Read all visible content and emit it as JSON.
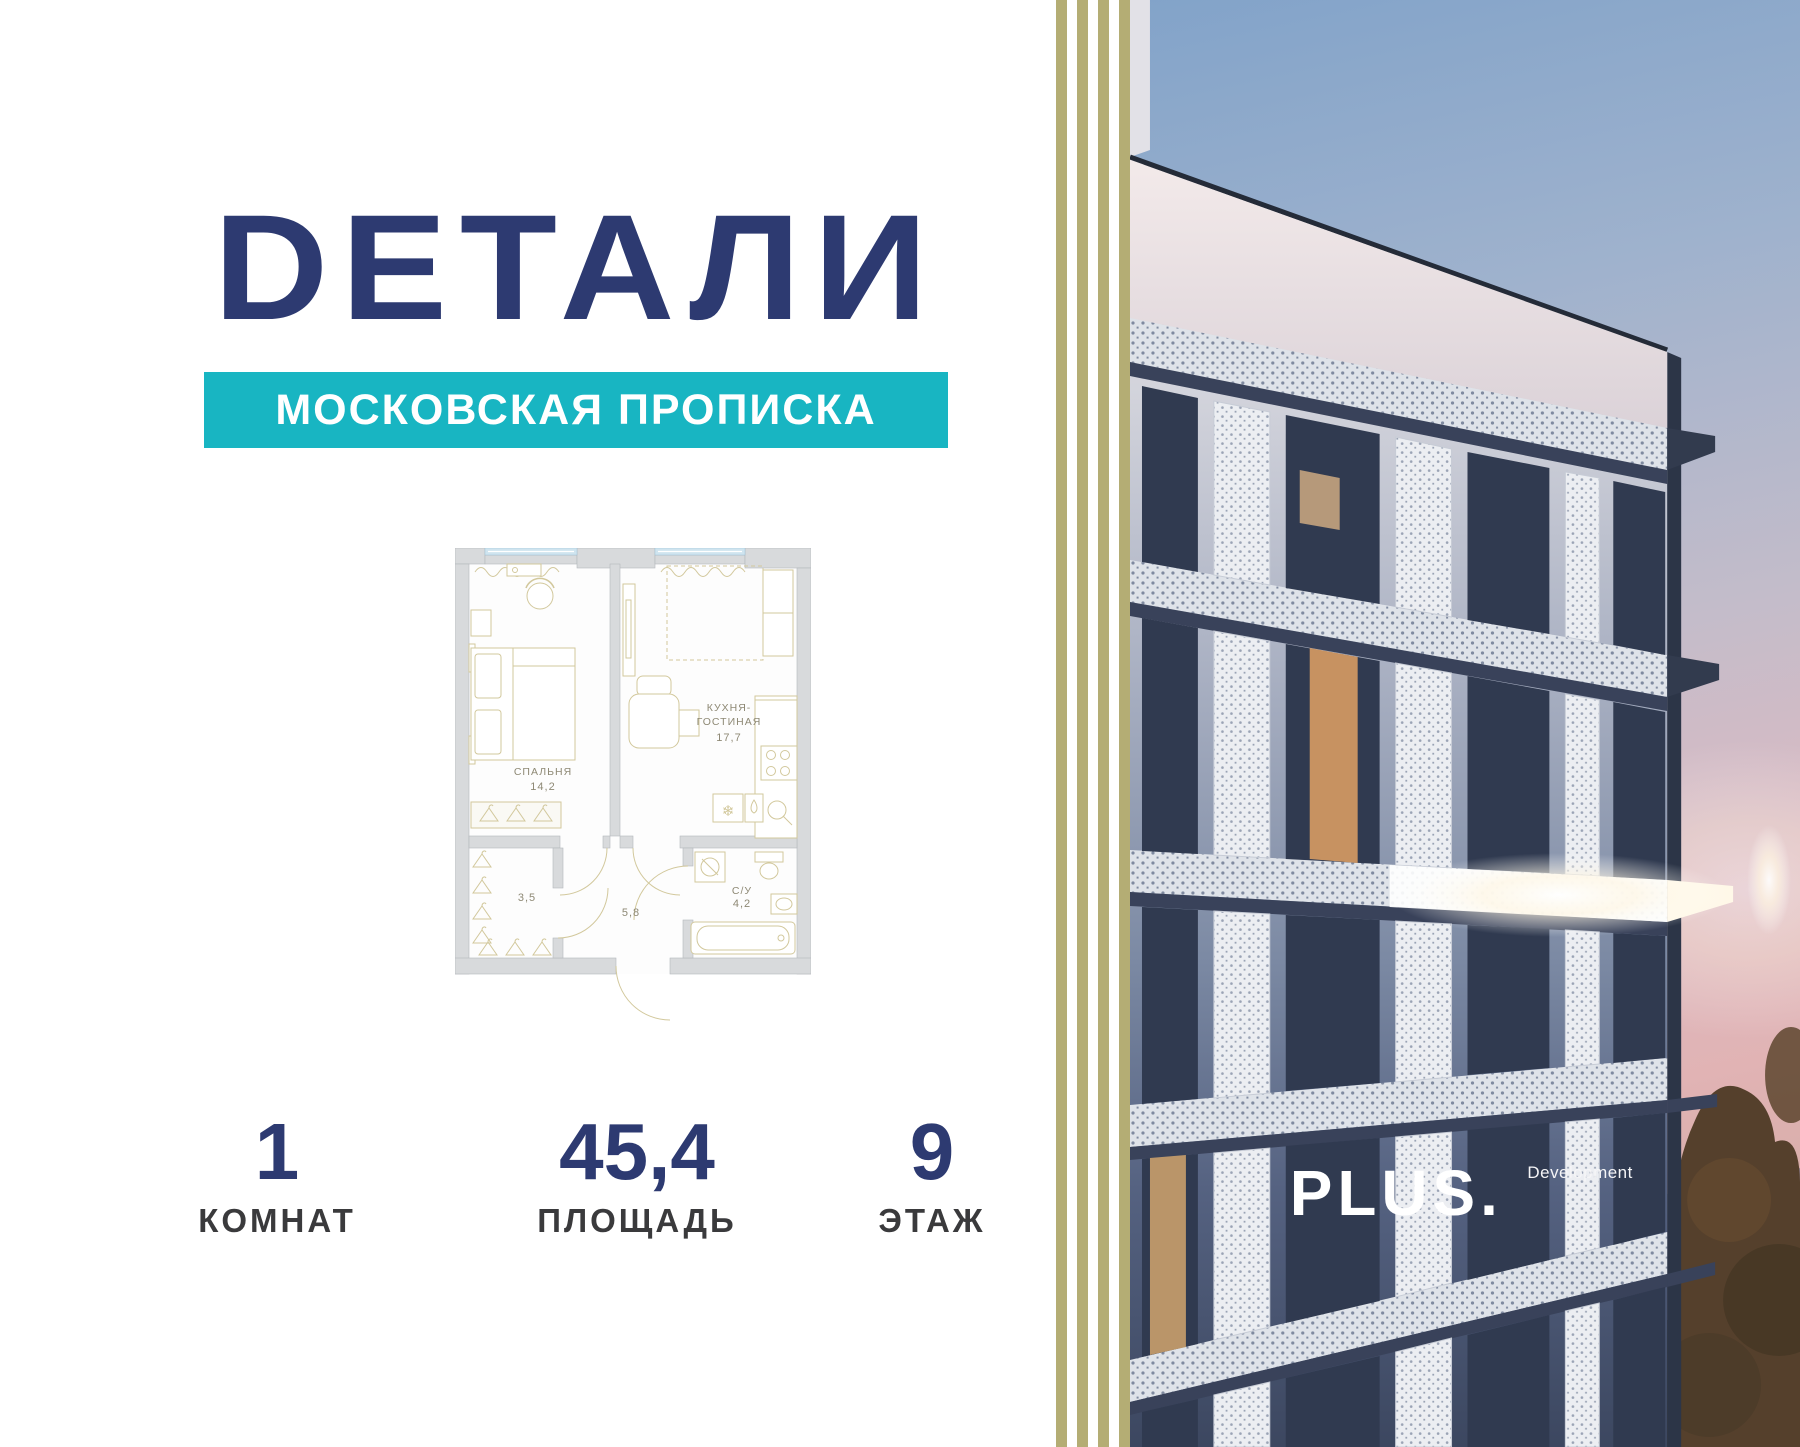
{
  "brand": {
    "logo_text": "DЕТАЛИ",
    "tagline": "МОСКОВСКАЯ ПРОПИСКА"
  },
  "colors": {
    "navy": "#2d3a71",
    "teal": "#18b5c2",
    "stripe_olive": "#b4ad74",
    "plan_furniture": "#d2c89c",
    "plan_wall": "#d8dadc",
    "plan_window_blue": "#cfe4ef",
    "stat_label_gray": "#3a3a3c"
  },
  "floorplan": {
    "bedroom": {
      "name": "СПАЛЬНЯ",
      "area": "14,2"
    },
    "kitchen": {
      "name_line1": "КУХНЯ-",
      "name_line2": "ГОСТИНАЯ",
      "area": "17,7"
    },
    "bathroom": {
      "name": "С/У",
      "area": "4,2"
    },
    "wardrobe": {
      "area": "3,5"
    },
    "hallway": {
      "area": "5,8"
    }
  },
  "stats": {
    "rooms": {
      "value": "1",
      "label": "КОМНАТ"
    },
    "area": {
      "value": "45,4",
      "label": "ПЛОЩАДЬ"
    },
    "floor": {
      "value": "9",
      "label": "ЭТАЖ"
    }
  },
  "developer": {
    "name": "PLUS.",
    "suffix": "Development"
  }
}
